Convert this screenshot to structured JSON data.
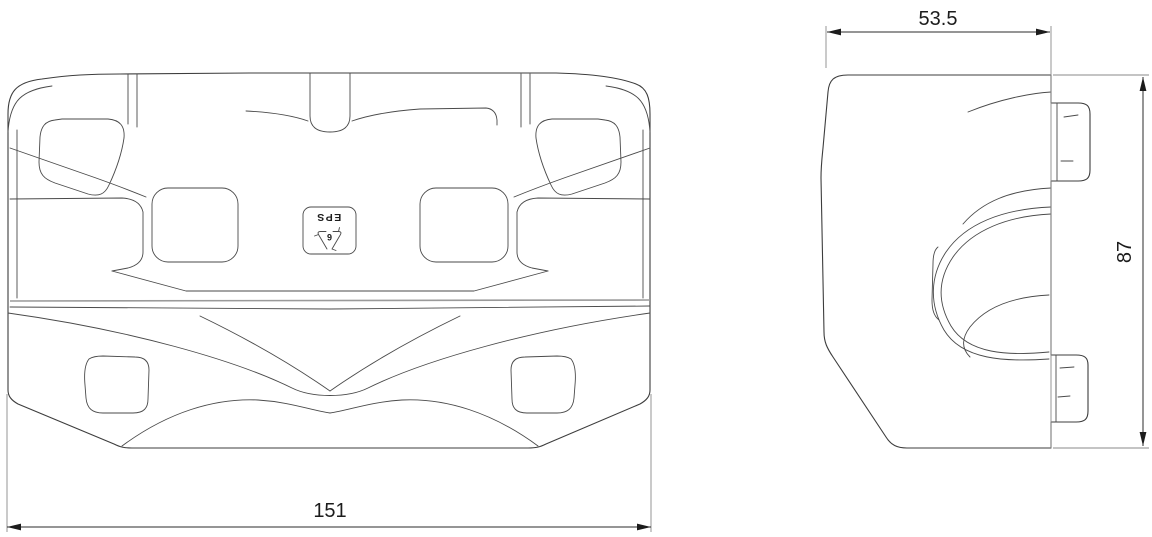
{
  "drawing": {
    "dimensions": {
      "front_width": "151",
      "side_width": "53.5",
      "side_height": "87"
    },
    "marking": {
      "material": "EPS",
      "resin_code": "6"
    },
    "colors": {
      "background": "#ffffff",
      "part_line": "#3d3d3d",
      "light_line": "#9a9a9a",
      "dimension_line": "#2b2b2b",
      "text": "#1c1c1c"
    }
  }
}
